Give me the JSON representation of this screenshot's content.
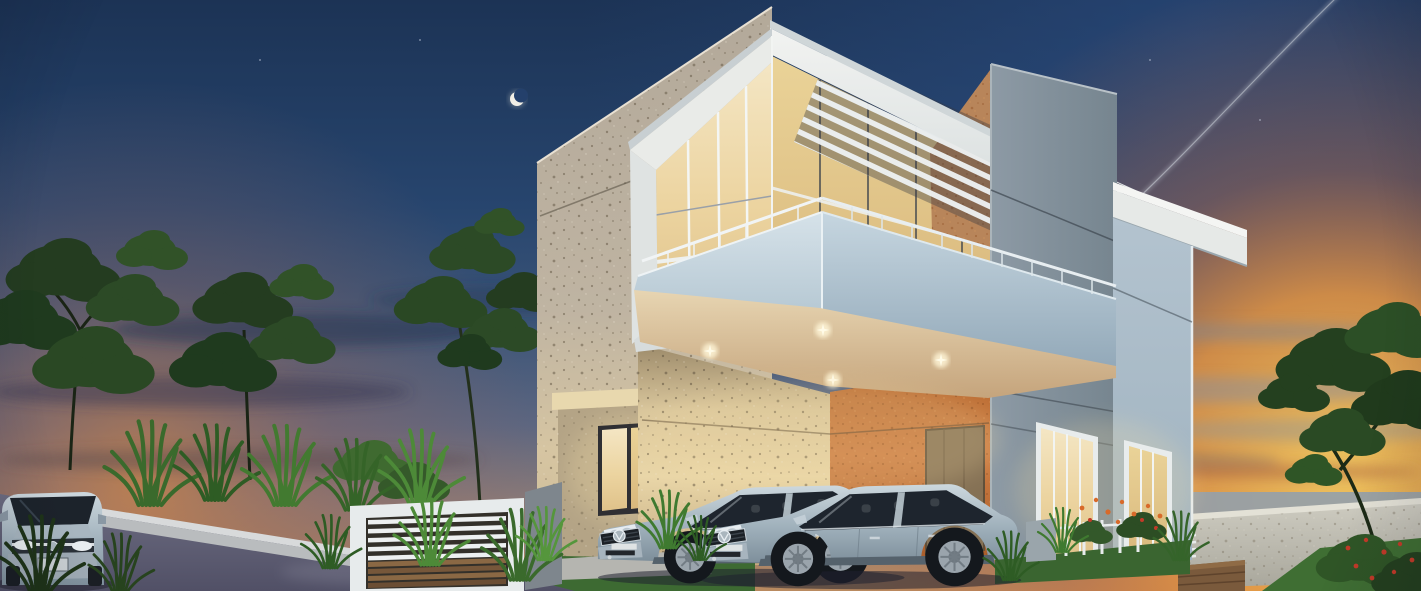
{
  "scene": {
    "type": "3d-architectural-exterior-render",
    "description": "Modern two-storey house with cantilevered balcony and louvred pergola at dusk; two silver Volkswagen sedans parked in the carport, a silver hatchback on the street; crescent moon upper left, jet contrail and sunset glow at right",
    "time_of_day": "dusk",
    "objects": [
      "dusk-sky",
      "crescent-moon",
      "jet-contrail",
      "cloud-streaks",
      "star-specks",
      "left-tree-silhouettes",
      "ornamental-grasses",
      "travertine-facade",
      "entry-window",
      "upper-glass-lounge",
      "louvred-pergola",
      "roof-fascia",
      "tan-accent-gable",
      "cantilevered-balcony",
      "balcony-railing",
      "recessed-downlights",
      "warm-carport-wall",
      "orange-accent-wall",
      "carport-door",
      "grey-service-pillar",
      "right-wing-roof-slab",
      "right-wing-wall",
      "lit-ground-windows",
      "white-gate-screen",
      "timber-slat-panel",
      "street-retaining-wall",
      "asphalt-street",
      "entry-step-slabs",
      "silver-hatchback",
      "vw-sedan-rear",
      "vw-sedan-front",
      "garden-fence-flowers",
      "sea-horizon-band",
      "boundary-wall",
      "sunset-lawn",
      "wooden-planter",
      "foreground-tree",
      "flower-bush"
    ],
    "colors": {
      "sky_top": "#1c3355",
      "sky_mid": "#2d4b76",
      "sky_haze": "#5d6680",
      "sunset_orange": "#e8953f",
      "sunset_yellow": "#f5c95e",
      "sunset_ember": "#c65a2e",
      "cloud_grey": "#8b8f9a",
      "moon": "#f2efe6",
      "travertine": "#b9b0a2",
      "travertine_lit": "#e3d0a4",
      "speckle": "#5f5340",
      "orange_wall": "#c07038",
      "accent_door": "#857155",
      "white_trim": "#eceeec",
      "balcony_face": "#c2d3de",
      "soffit_warm": "#ecd9b4",
      "pillar_grey": "#84929d",
      "right_wall": "#a9bcca",
      "glass_warm": "#f2dfb6",
      "glass_deep": "#e2bd7e",
      "lawn": "#47763a",
      "foliage_dark": "#24401f",
      "foliage_mid": "#2f5526",
      "grass_bright": "#4d8a38",
      "road": "#66667c",
      "road_dark": "#4e4e62",
      "curb": "#d2d5d6",
      "car_silver": "#b4c2cc",
      "car_glass": "#222a34",
      "wood": "#8a6844",
      "boundary_wall": "#c6c4ba",
      "flower_orange": "#d86a2a",
      "flower_red": "#c23a28"
    }
  }
}
